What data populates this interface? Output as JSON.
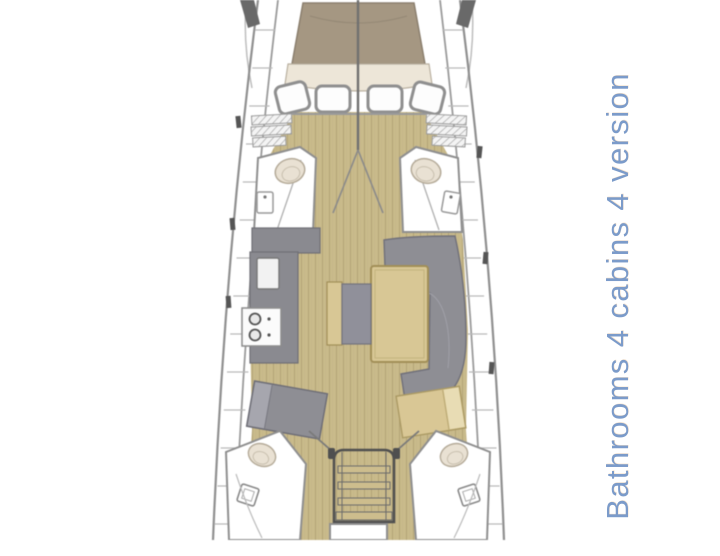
{
  "caption": {
    "text": "Bathrooms 4 cabins 4 version"
  },
  "colors": {
    "hull-line": "#8f8f8f",
    "deck-line": "#b8b8b8",
    "wood-floor": "#c9ba8b",
    "wood-plank-line": "#b3a477",
    "bow-mattress": "#a59782",
    "cushion-gray": "#8e8e94",
    "furniture-wood": "#d8c795",
    "fixture-cream": "#e9e1d3",
    "caption-blue": "#7b9bca",
    "paper": "#ffffff"
  }
}
